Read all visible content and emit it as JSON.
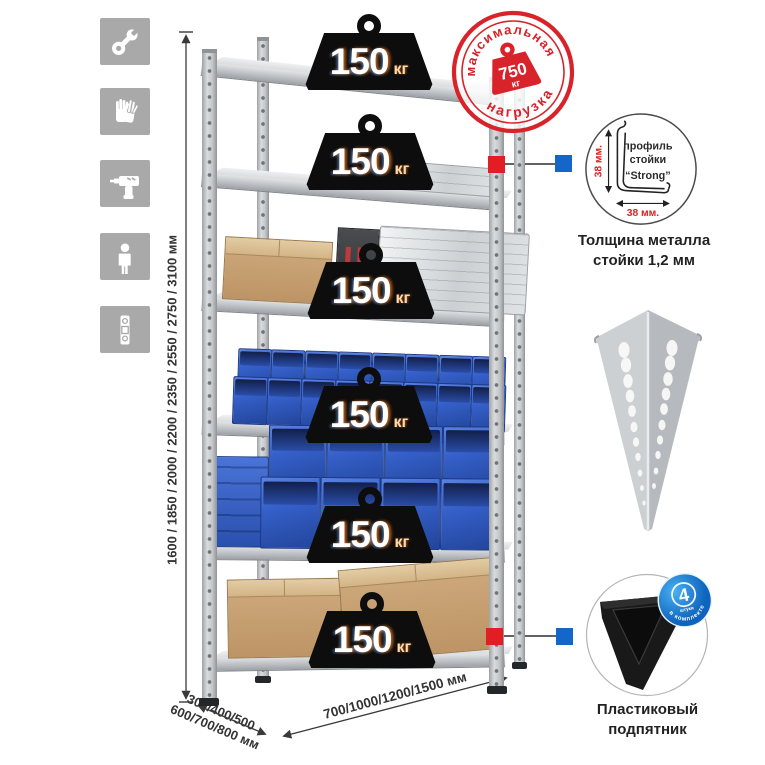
{
  "rack": {
    "shelf_count": 6,
    "load_value": "150",
    "load_unit": "кг"
  },
  "stamp": {
    "arc_top": "максимальная",
    "arc_bottom": "нагрузка",
    "value": "750",
    "unit": "кг"
  },
  "dimensions": {
    "height_label": "1600 / 1850 / 2000 / 2200 / 2350 / 2550 / 2750 / 3100 мм",
    "depth_label_line1": "300/400/500",
    "depth_label_line2": "600/700/800 мм",
    "width_label": "700/1000/1200/1500 мм"
  },
  "profile_callout": {
    "line1": "профиль",
    "line2": "стойки",
    "line3": "“Strong”",
    "dim_vertical": "38 мм.",
    "dim_horizontal": "38 мм.",
    "caption1": "Толщина металла",
    "caption2": "стойки 1,2 мм"
  },
  "foot_callout": {
    "badge_value": "4",
    "badge_unit": "штуки",
    "badge_arc": "в комплекте",
    "caption1": "Пластиковый",
    "caption2": "подпятник"
  },
  "feature_icons": [
    "wrench",
    "gloves",
    "drill",
    "person",
    "level"
  ],
  "colors": {
    "stamp_red": "#d8232a",
    "marker_red": "#e21d23",
    "marker_blue": "#1467c8",
    "bin_blue": "#2f5ec4",
    "weight_black": "#0d0d0d",
    "icon_gray": "#a9a9a9",
    "metal_light": "#d9dbdd",
    "cardboard": "#c7a172"
  }
}
